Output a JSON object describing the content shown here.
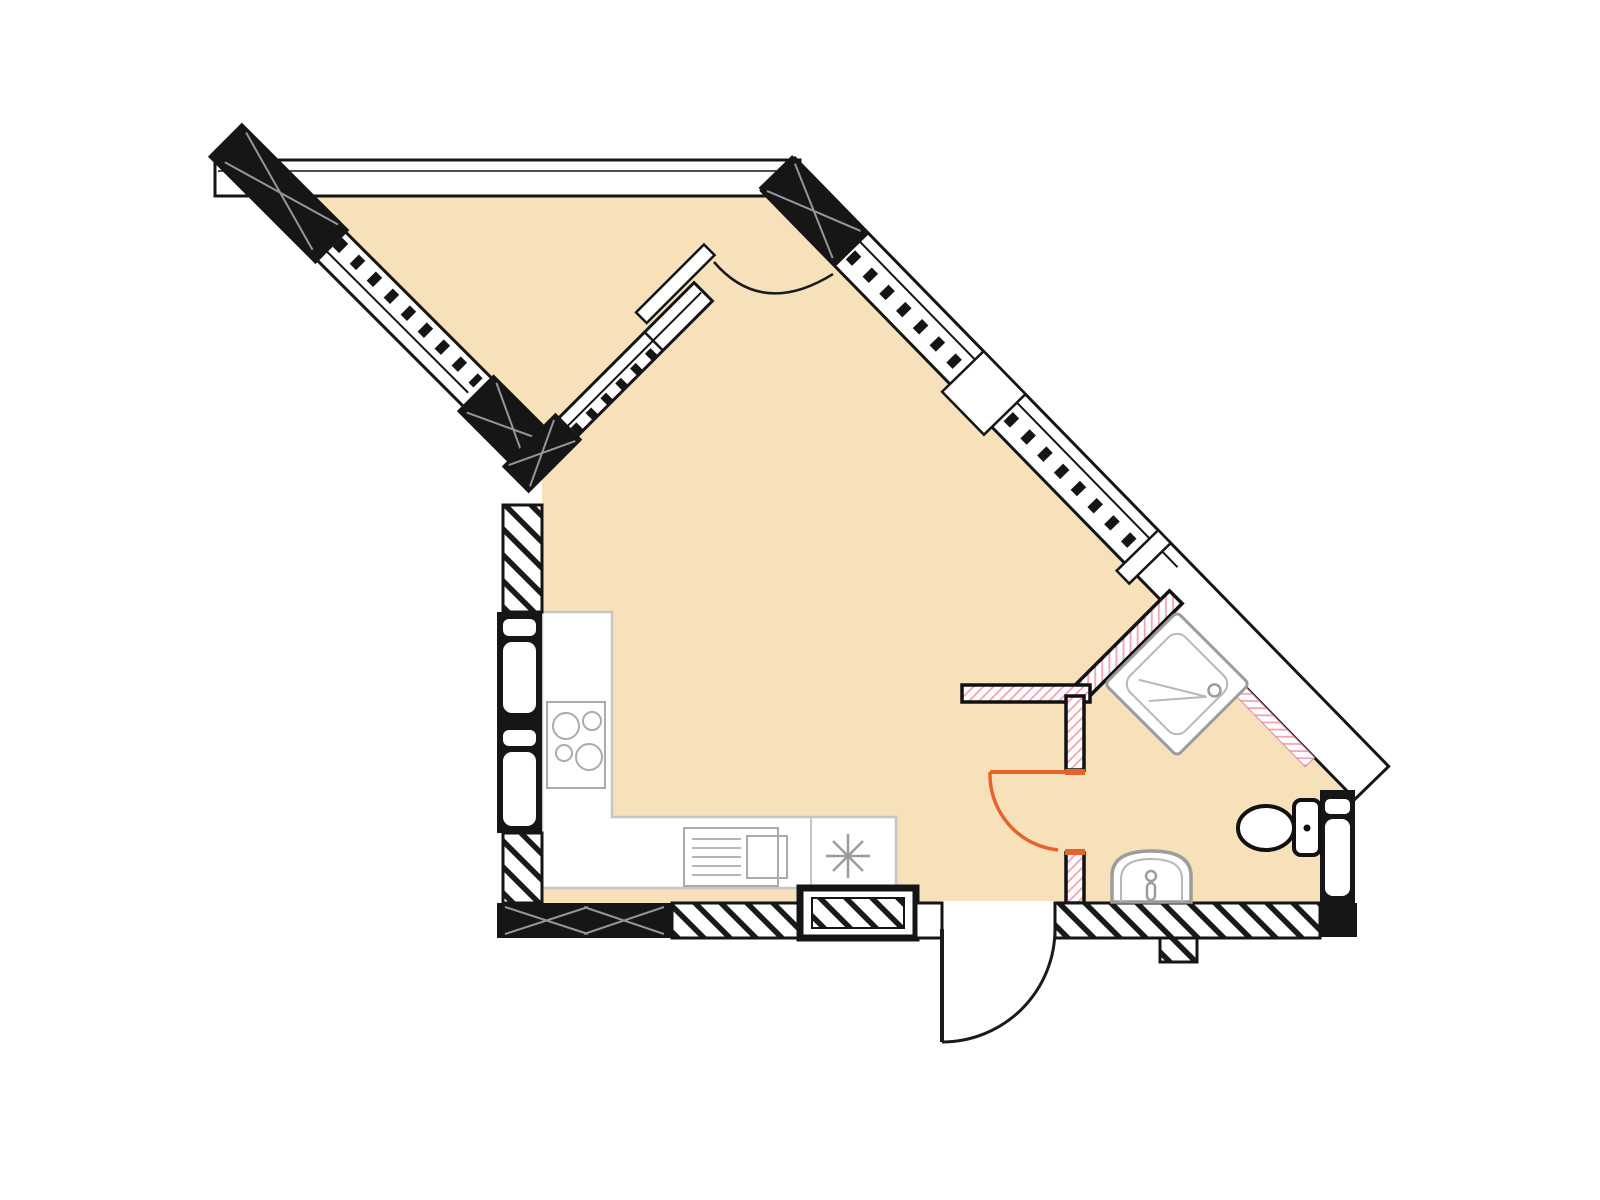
{
  "canvas": {
    "width": 1600,
    "height": 1200,
    "background": "#ffffff"
  },
  "colors": {
    "floor": "#f6e1ba",
    "wall_line": "#151515",
    "wall_black_fill": "#161616",
    "hatch_black": "#1a1a1a",
    "hatch_pink": "#f0a4b4",
    "partition_edge": "#111111",
    "door_swing_orange": "#e8632c",
    "door_swing_black": "#1a1a1a",
    "fixture_outline": "#9c9c9c",
    "fixture_outline_light": "#b8b8b8",
    "counter_outline": "#c6c6c6",
    "pier_accent": "#ffffff"
  },
  "plan": {
    "type": "architectural floor plan (no text labels on sheet)",
    "rooms": [
      {
        "name": "balcony",
        "shape": "triangular, glazed diagonal front"
      },
      {
        "name": "living-room-with-kitchen",
        "shape": "irregular pentagon"
      },
      {
        "name": "bathroom",
        "shape": "corner room at right"
      }
    ],
    "windows": [
      {
        "name": "balcony-front-window",
        "location": "top-left diagonal wall, mullioned glazing between two black piers"
      },
      {
        "name": "living-room-window",
        "location": "top-right diagonal wall, mullioned glazing with frame steps"
      },
      {
        "name": "balcony-partition-glazing",
        "location": "interior diagonal partition between balcony and room"
      }
    ],
    "doors": [
      {
        "name": "balcony-door",
        "swing": "arc into living room",
        "color_key": "door_swing_black"
      },
      {
        "name": "bathroom-door",
        "swing": "quarter arc into room",
        "color_key": "door_swing_orange"
      },
      {
        "name": "entry-door",
        "swing": "quarter arc outward at bottom",
        "color_key": "door_swing_black"
      }
    ],
    "fixtures": [
      {
        "name": "kitchen-counter",
        "detail": "L-shaped along left and bottom walls"
      },
      {
        "name": "stove-4-burner",
        "detail": "two large + two small burner circles"
      },
      {
        "name": "built-in-appliance",
        "detail": "vented front panel with square door"
      },
      {
        "name": "kitchen-sink-symbol",
        "detail": "eight-point asterisk on counter"
      },
      {
        "name": "corner-shower",
        "detail": "rotated square tray with drain"
      },
      {
        "name": "toilet",
        "detail": "against right ventilation wall"
      },
      {
        "name": "washbasin",
        "detail": "arched basin on bottom bathroom wall"
      },
      {
        "name": "ventilation-shafts",
        "detail": "black wall blocks with white slots, left and right"
      },
      {
        "name": "duct-box",
        "detail": "hatched box protruding from bottom wall"
      }
    ]
  }
}
